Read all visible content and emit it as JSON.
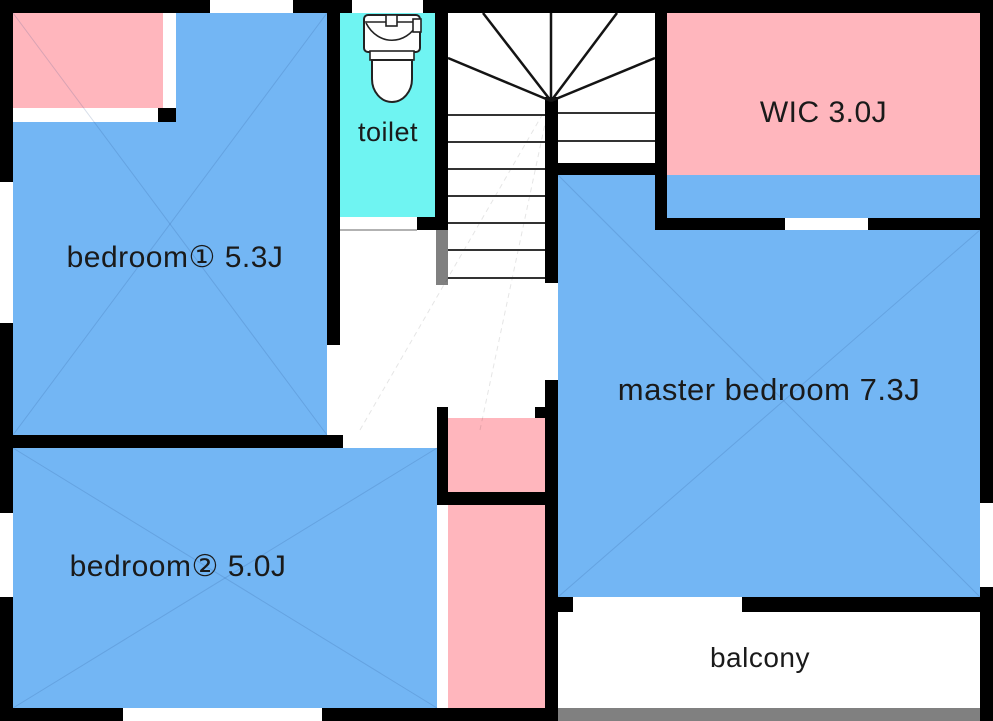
{
  "floorplan": {
    "rooms": {
      "bedroom1": {
        "label": "bedroom① 5.3J"
      },
      "bedroom2": {
        "label": "bedroom② 5.0J"
      },
      "toilet": {
        "label": "toilet"
      },
      "wic": {
        "label": "WIC 3.0J"
      },
      "master_bedroom": {
        "label": "master bedroom 7.3J"
      },
      "balcony": {
        "label": "balcony"
      }
    },
    "colors": {
      "room_fill_blue": "#73B6F4",
      "closet_fill_pink": "#FFB6BD",
      "toilet_fill_cyan": "#6FF4F2",
      "balcony_railing_gray": "#808080",
      "wall_black": "#000000",
      "label_text": "#1a1a1a"
    }
  }
}
